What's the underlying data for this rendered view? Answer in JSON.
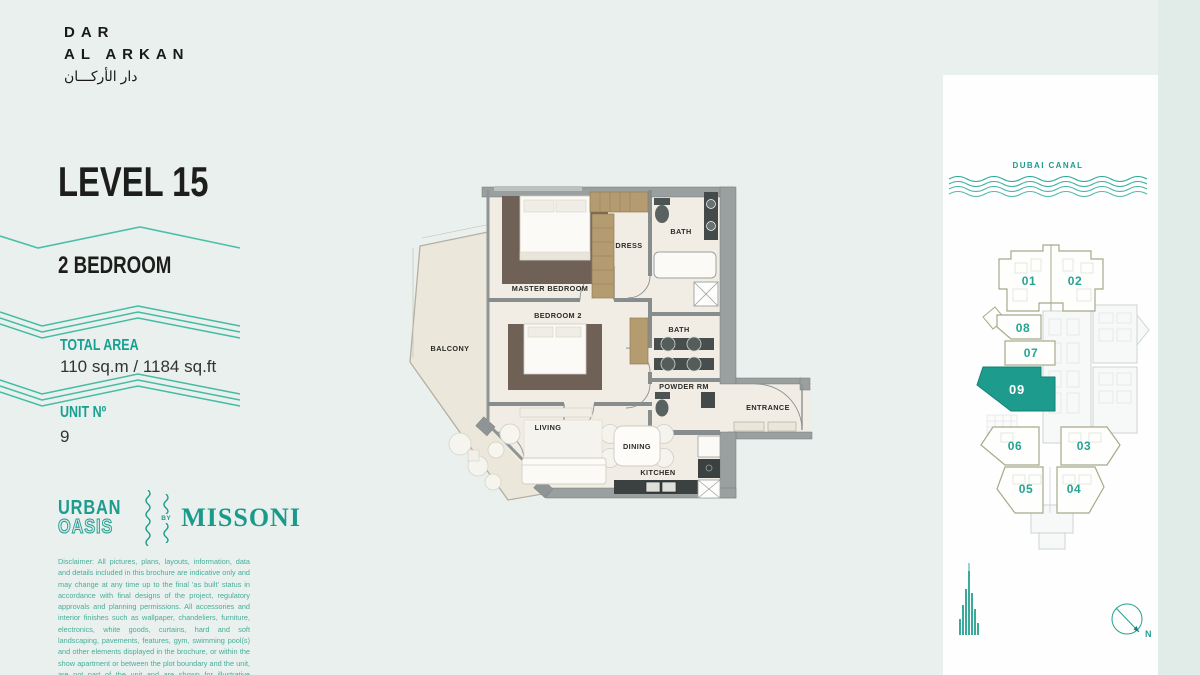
{
  "brand": {
    "line1": "DAR",
    "line2": "AL ARKAN",
    "line3": "دار الأركـــان"
  },
  "panel_left": {
    "level": "LEVEL 15",
    "bedrooms": "2 BEDROOM",
    "total_area_label": "TOTAL AREA",
    "total_area_value": "110 sq.m / 1184 sq.ft",
    "unit_label": "UNIT Nº",
    "unit_value": "9",
    "logo": {
      "urban": "URBAN",
      "oasis": "OASIS",
      "by": "BY",
      "missoni": "MISSONI"
    },
    "disclaimer": "Disclaimer: All pictures, plans, layouts, information, data and details included in this brochure are indicative only and may change at any time up to the final 'as built' status in accordance with final designs of the project, regulatory approvals and planning permissions. All accessories and interior finishes such as wallpaper, chandeliers, furniture, electronics, white goods, curtains, hard and soft landscaping, pavements, features, gym, swimming pool(s) and other elements displayed in the brochure, or within the show apartment or between the plot boundary and the unit, are not part of the unit and are shown for illustrative purposes only."
  },
  "floor_plan": {
    "labels": {
      "master_bedroom": "MASTER BEDROOM",
      "bedroom2": "BEDROOM 2",
      "dress": "DRESS",
      "bath1": "BATH",
      "bath2": "BATH",
      "powder": "POWDER RM",
      "balcony": "BALCONY",
      "living": "LIVING",
      "dining": "DINING",
      "kitchen": "KITCHEN",
      "entrance": "ENTRANCE"
    }
  },
  "key_plan": {
    "canal_label": "DUBAI CANAL",
    "units": [
      "01",
      "02",
      "08",
      "07",
      "09",
      "06",
      "03",
      "05",
      "04"
    ],
    "highlighted_unit": "09",
    "compass_north": "N"
  },
  "colors": {
    "accent": "#17a091",
    "accent_wave": "#2aa896",
    "highlight_unit_fill": "#1d9c8e",
    "olive_outline": "#a9a98c",
    "dark_text": "#1d1d1b",
    "page_bg": "#eaf0ee",
    "panel_bg": "#fdfefd"
  }
}
